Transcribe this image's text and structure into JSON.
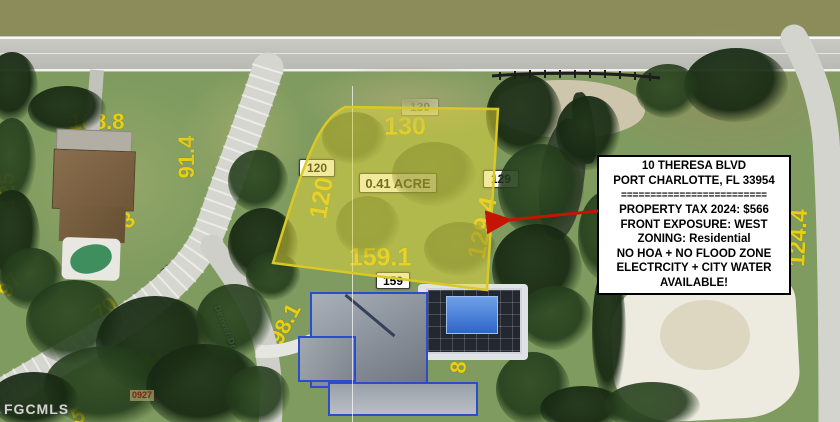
{
  "image_type": "aerial-parcel-map",
  "colors": {
    "annotation_yellow": "#eace10",
    "lot_highlight_fill": "rgba(228,213,58,0.5)",
    "lot_highlight_stroke": "#d9c826",
    "arrow_red": "#c41504",
    "label_box_bg": "#ffffff",
    "label_box_text": "#000000",
    "street_label_text": "#ffffff"
  },
  "streets": {
    "top": "Hillsborough Blvd",
    "diagonal": "Theresa Blvd",
    "branch": "Denver Dr"
  },
  "subject_lot": {
    "acreage": "0.41 ACRE",
    "top_box": "130",
    "top_text": "130",
    "left_box": "120",
    "left_text": "120",
    "right_box": "129",
    "right_text": "129.4",
    "bottom_text": "159.1",
    "bottom_box": "159"
  },
  "info_box": {
    "lines": [
      "10 THERESA BLVD",
      "PORT CHARLOTTE, FL 33954",
      "=========================",
      "PROPERTY TAX 2024: $566",
      "FRONT EXPOSURE:  WEST",
      "ZONING:  Residential",
      "NO HOA + NO FLOOD ZONE",
      "ELECTRCITY + CITY WATER",
      "AVAILABLE!"
    ]
  },
  "parcel_numbers": [
    {
      "v": "108.8"
    },
    {
      "v": "91.4"
    },
    {
      "v": "125"
    },
    {
      "v": "122.3"
    },
    {
      "v": "97"
    },
    {
      "v": "70"
    },
    {
      "v": "94.6"
    },
    {
      "v": "98.1"
    },
    {
      "v": "129.1"
    },
    {
      "v": "87.4"
    },
    {
      "v": "80"
    },
    {
      "v": "124.4"
    },
    {
      "v": "5"
    },
    {
      "v": "5"
    }
  ],
  "watermark": "FGCMLS",
  "plat_code": "0927"
}
